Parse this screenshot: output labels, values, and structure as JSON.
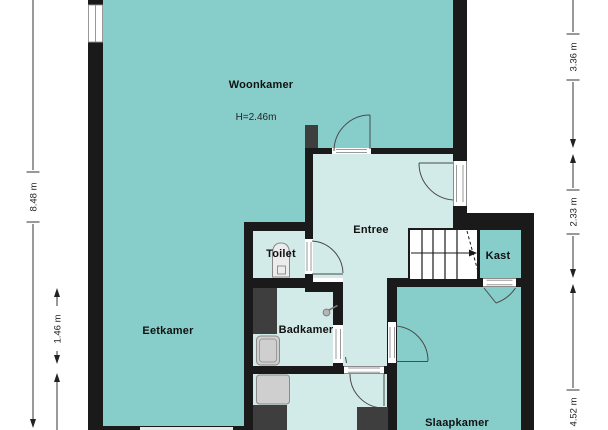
{
  "floor_plan": {
    "rooms": {
      "woonkamer": {
        "label": "Woonkamer",
        "ceiling_height": "H=2.46m"
      },
      "eetkamer": {
        "label": "Eetkamer"
      },
      "entree": {
        "label": "Entree"
      },
      "toilet": {
        "label": "Toilet"
      },
      "badkamer": {
        "label": "Badkamer"
      },
      "kast": {
        "label": "Kast"
      },
      "slaapkamer": {
        "label": "Slaapkamer"
      }
    },
    "dimensions": {
      "left_total": "8.48 m",
      "left_partial": "1.46 m",
      "right_top": "3.36 m",
      "right_middle": "2.33 m",
      "right_bottom": "4.52 m"
    },
    "colors": {
      "room_teal": "#87cecb",
      "room_light": "#d3ebe8",
      "wall": "#1a1a1a",
      "fixture_dark": "#3e3e3e",
      "fixture_light": "#cfcfcf",
      "stairs_fill": "#ffffff"
    }
  }
}
